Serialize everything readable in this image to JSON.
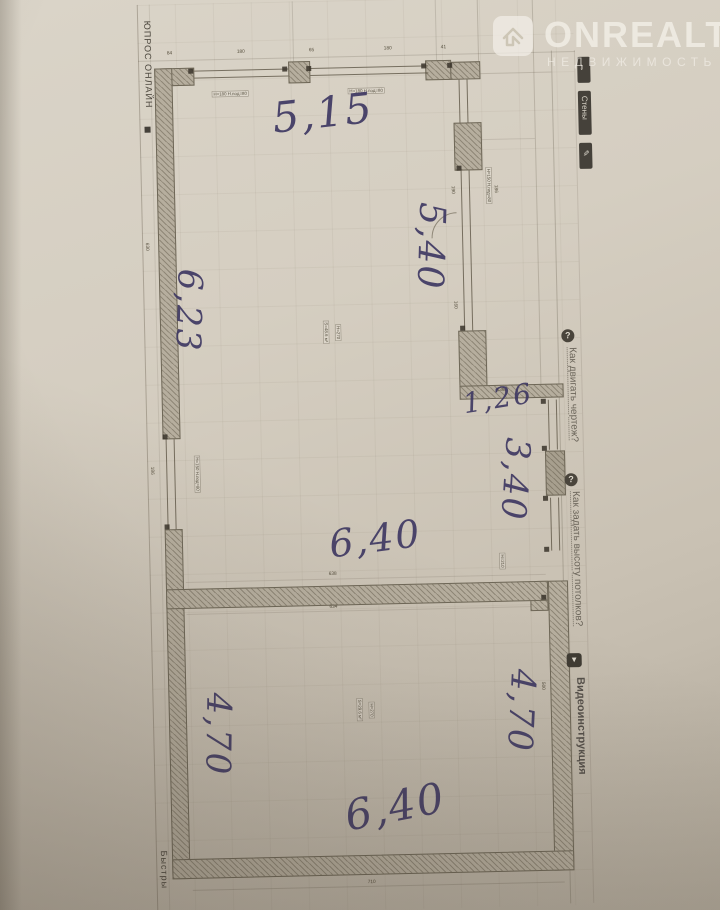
{
  "watermark": {
    "brand": "ONREALT",
    "subtitle": "НЕДВИЖИМОСТЬ"
  },
  "page_labels": {
    "top_left": "ЮПРОС ОНЛАЙН",
    "bottom_left": "Быстры"
  },
  "sidebar": {
    "walls_tool": "Стены",
    "help_move": "Как двигать чертеж?",
    "help_ceiling": "Как задать высоту потолков?",
    "video": "Видеоинструкция"
  },
  "handwritten": {
    "top_width": "5,15",
    "right_upper": "5,40",
    "left_upper": "6,23",
    "step": "1,26",
    "right_mid": "3,40",
    "mid_width": "6,40",
    "left_lower": "4,70",
    "right_lower": "4,70",
    "bottom_width": "6,40"
  },
  "printed_dims": {
    "top": [
      "84",
      "180",
      "65",
      "180",
      "41"
    ],
    "left_upper": "630",
    "left_lower": "186",
    "right_win_a": "190",
    "right_win_b": "186",
    "right_win_c": "160",
    "step_dim": "136",
    "mid_above": "638",
    "mid_below": "634",
    "bottom": "710",
    "right_lower": "500"
  },
  "labels": {
    "window_top_1": "H=180 H.под=80",
    "window_top_2": "H=180 H.под=80",
    "window_right": "H=150 H.под=80",
    "window_left": "H=150 H.под=80",
    "door": "H=210",
    "room_upper_area": "S=48.6 м²",
    "room_upper_height": "H=270",
    "room_lower_area": "S=29.6 м²",
    "room_lower_height": "H=270"
  },
  "colors": {
    "paper": "#d3ccbe",
    "ink": "#3f3963",
    "wall": "#b6ae9e",
    "plan_line": "#6e6757",
    "watermark": "#f3efe7"
  }
}
